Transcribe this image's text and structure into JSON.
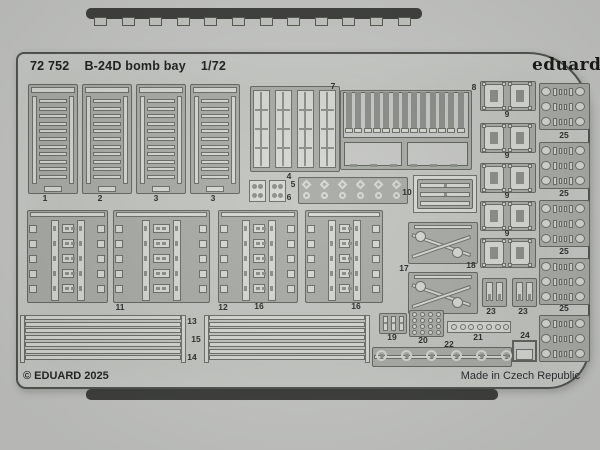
{
  "product": {
    "catalog_number": "72 752",
    "title": "B-24D bomb bay",
    "scale": "1/72"
  },
  "brand": {
    "logo": "eduard"
  },
  "footer": {
    "copyright": "© EDUARD 2025",
    "origin": "Made in Czech Republic"
  },
  "colors": {
    "backdrop": "#c7c8c5",
    "fret_metal": "#c3c5c1",
    "etched_web": "#a8aba6",
    "part_face": "#d6d8d3",
    "outline": "#5f615b",
    "packaging_strip": "#3b3c39",
    "text": "#1b1c1a"
  },
  "fret": {
    "counts": {
      "ladders": 4,
      "panel_rows": 5,
      "slat_count": 7,
      "teeth": 13,
      "blocks_9": 5,
      "blocks_25": 5,
      "rows_25": 3,
      "tabs_top": 12,
      "tabs_bottom": 14
    },
    "part_labels": [
      {
        "text": "1",
        "x": 45,
        "y": 198
      },
      {
        "text": "2",
        "x": 100,
        "y": 198
      },
      {
        "text": "3",
        "x": 156,
        "y": 198
      },
      {
        "text": "3",
        "x": 213,
        "y": 198
      },
      {
        "text": "4",
        "x": 289,
        "y": 176
      },
      {
        "text": "5",
        "x": 293,
        "y": 184
      },
      {
        "text": "6",
        "x": 289,
        "y": 197
      },
      {
        "text": "7",
        "x": 333,
        "y": 86
      },
      {
        "text": "8",
        "x": 474,
        "y": 87
      },
      {
        "text": "9",
        "x": 507,
        "y": 114
      },
      {
        "text": "9",
        "x": 507,
        "y": 155
      },
      {
        "text": "9",
        "x": 507,
        "y": 195
      },
      {
        "text": "9",
        "x": 507,
        "y": 233
      },
      {
        "text": "10",
        "x": 407,
        "y": 192
      },
      {
        "text": "11",
        "x": 120,
        "y": 307
      },
      {
        "text": "12",
        "x": 223,
        "y": 307
      },
      {
        "text": "16",
        "x": 259,
        "y": 306
      },
      {
        "text": "16",
        "x": 356,
        "y": 306
      },
      {
        "text": "13",
        "x": 192,
        "y": 321
      },
      {
        "text": "15",
        "x": 196,
        "y": 339
      },
      {
        "text": "14",
        "x": 192,
        "y": 357
      },
      {
        "text": "17",
        "x": 404,
        "y": 268
      },
      {
        "text": "18",
        "x": 471,
        "y": 265
      },
      {
        "text": "19",
        "x": 392,
        "y": 337
      },
      {
        "text": "20",
        "x": 423,
        "y": 340
      },
      {
        "text": "21",
        "x": 478,
        "y": 337
      },
      {
        "text": "22",
        "x": 449,
        "y": 344
      },
      {
        "text": "23",
        "x": 491,
        "y": 311
      },
      {
        "text": "23",
        "x": 523,
        "y": 311
      },
      {
        "text": "24",
        "x": 525,
        "y": 335
      },
      {
        "text": "25",
        "x": 564,
        "y": 135
      },
      {
        "text": "25",
        "x": 564,
        "y": 193
      },
      {
        "text": "25",
        "x": 564,
        "y": 251
      },
      {
        "text": "25",
        "x": 564,
        "y": 308
      }
    ]
  }
}
